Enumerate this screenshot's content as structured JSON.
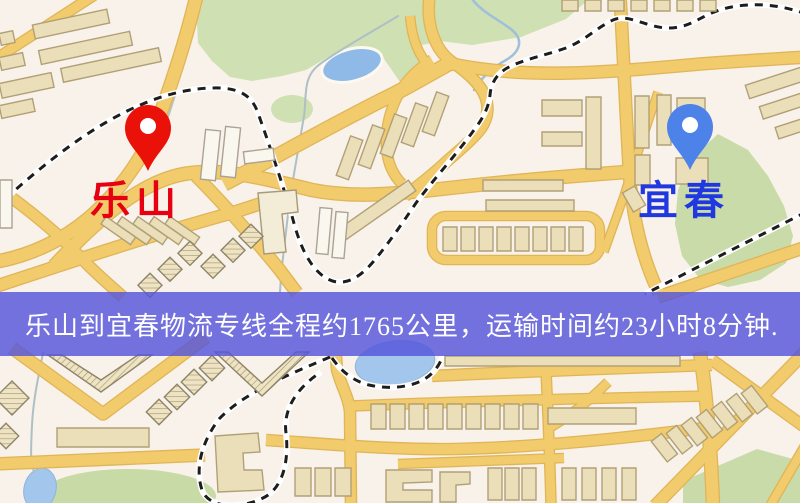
{
  "banner": {
    "text": "乐山到宜春物流专线全程约1765公里，运输时间约23小时8分钟.",
    "bg_rgba": "rgba(84,84,219,0.82)",
    "text_color": "#ffffff"
  },
  "markers": {
    "origin": {
      "label": "乐山",
      "label_color": "#e60012",
      "pin_color": "#ea1208"
    },
    "destination": {
      "label": "宜春",
      "label_color": "#2038e0",
      "pin_color": "#4d82e9"
    }
  },
  "map_colors": {
    "background": "#f8f2ea",
    "road": "#f1cb6c",
    "road_edge": "#e0b557",
    "building": "#ebdfb9",
    "building_edge": "#b1a077",
    "park": "#cfe0b2",
    "water": "#8fb9e6",
    "railway_dash": "#1d1d1d"
  }
}
